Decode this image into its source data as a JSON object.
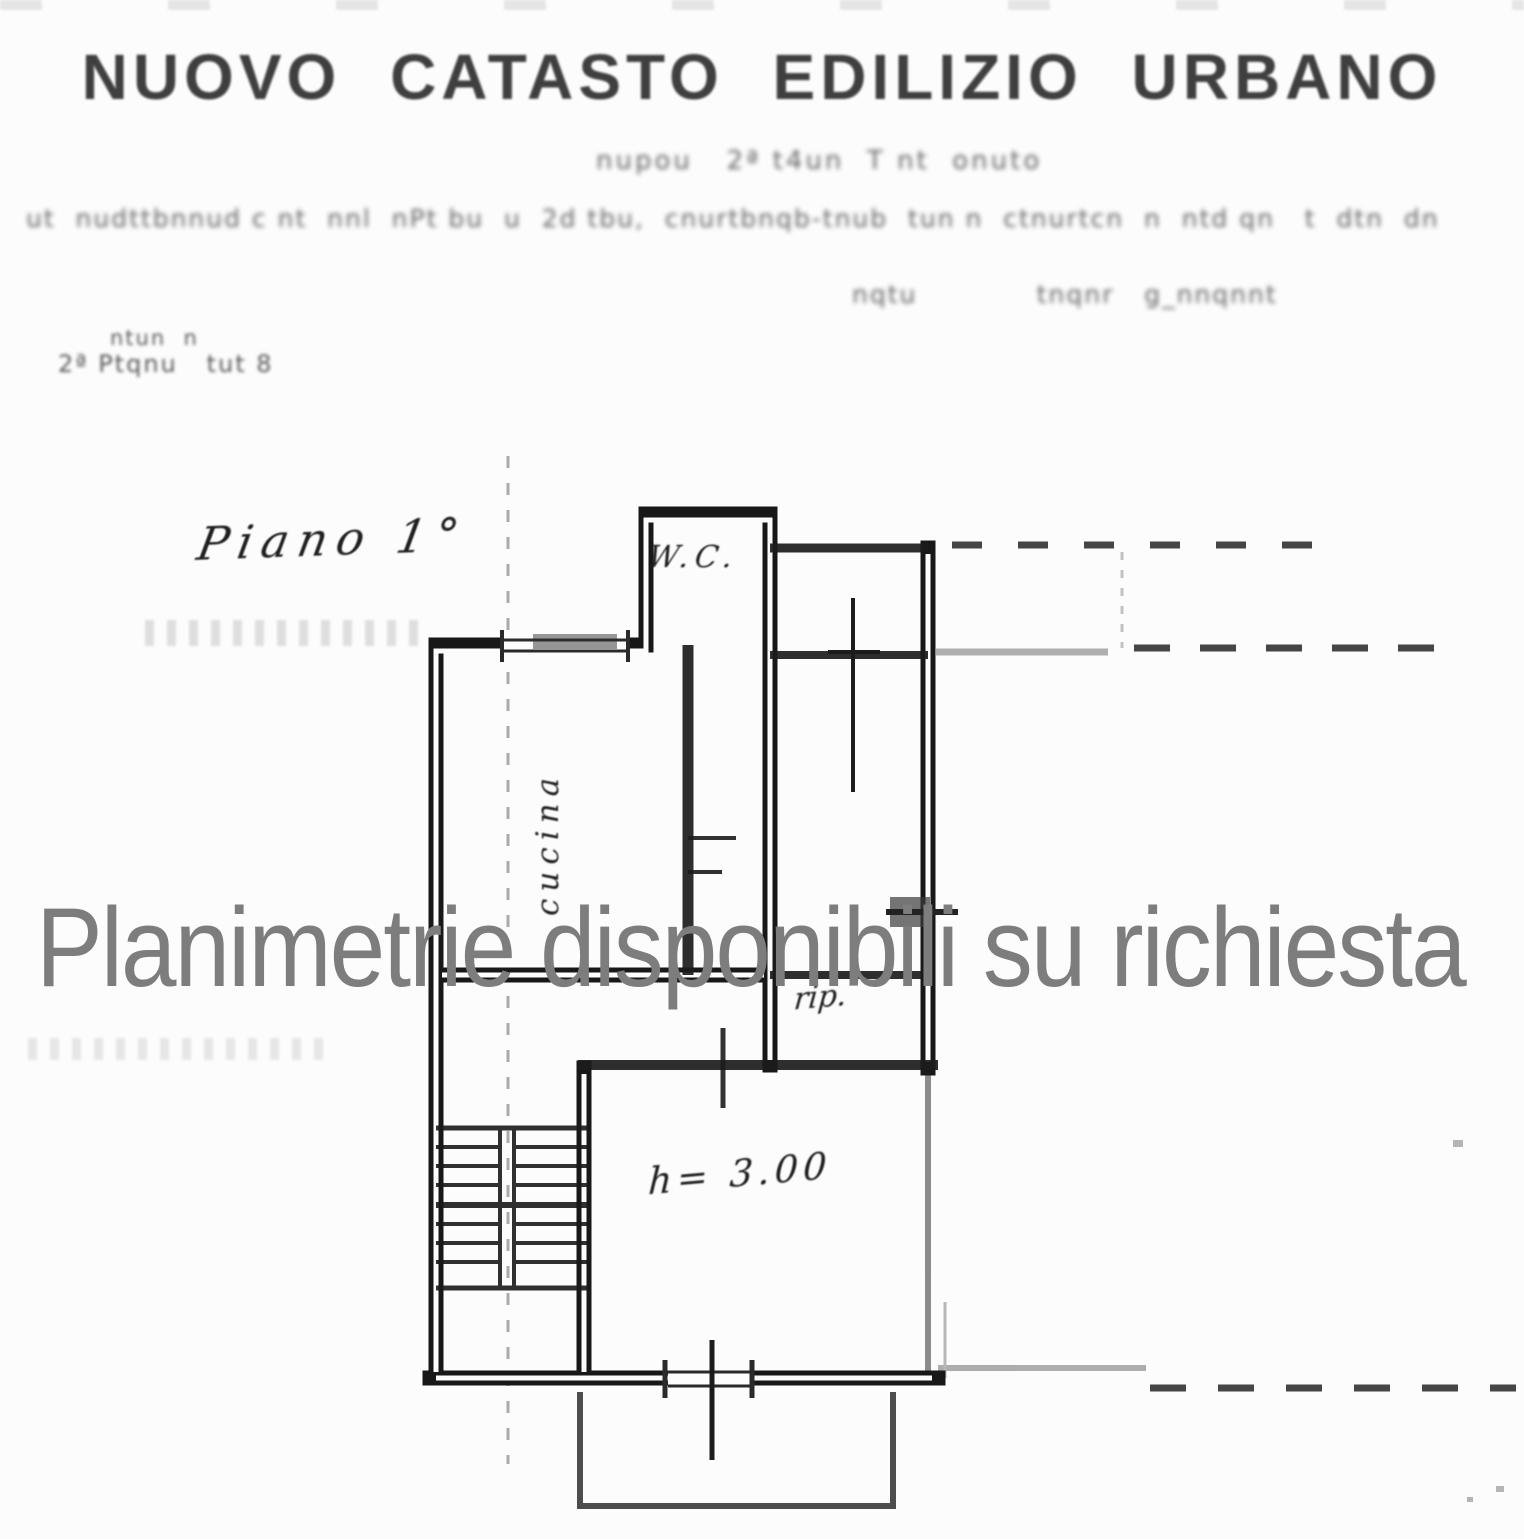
{
  "page": {
    "title": "NUOVO CATASTO EDILIZIO URBANO",
    "watermark": "Planimetrie disponibili su richiesta",
    "illegible_scan_lines": {
      "subtitle": "nupou   2ª t4un  T nt  onuto",
      "body": "ut  nudttbnnud c nt  nnl  nPt bu  u  2d tbu,  cnurtbnqb-tnub  tun n  ctnurtcn  n  ntd qn   t  dtn  dn",
      "right_pair": "nqtu            tnqnr   g_nnqnnt",
      "scale_note": "ntun  n",
      "floor_note": "2ª Ptqnu   tut 8"
    },
    "plan_labels": {
      "floor": "Piano 1°",
      "wc": "W.C.",
      "kitchen": "cucina",
      "storage": "rip.",
      "height": "h= 3.00"
    },
    "colors": {
      "ink": "#1c1c1c",
      "watermark_gray": "#7d7d7d",
      "faint_gray": "#9a9a9a",
      "paper": "#fcfcfc"
    }
  }
}
